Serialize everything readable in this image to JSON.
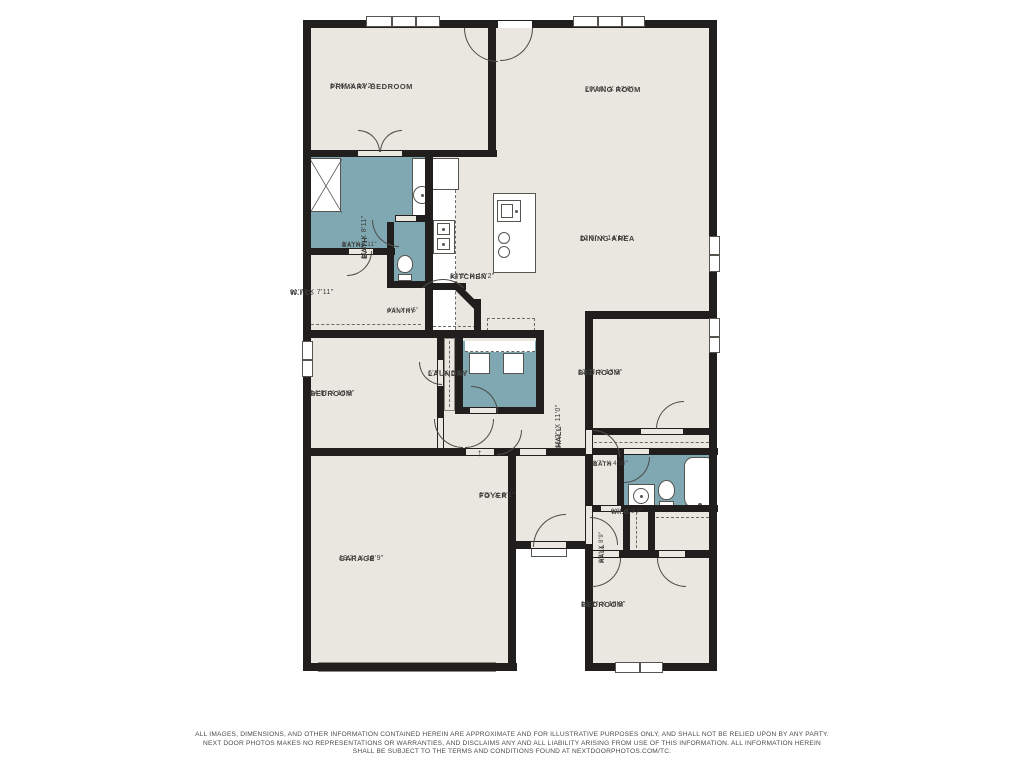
{
  "colors": {
    "floor": "#e9e7df",
    "wet_room": "#7fa8b2",
    "wall": "#201f1d",
    "fixture_line": "#55544f",
    "label_text": "#3e3e3c",
    "background": "#ffffff"
  },
  "rooms": [
    {
      "id": "primary-bedroom",
      "name": "PRIMARY BEDROOM",
      "dims": "17'6\" X 12'2\"",
      "x": 400,
      "y": 92,
      "rot": 0,
      "small": false
    },
    {
      "id": "living-room",
      "name": "LIVING ROOM",
      "dims": "20'10\" X 12'6\"",
      "x": 655,
      "y": 95,
      "rot": 0,
      "small": false
    },
    {
      "id": "dining-area",
      "name": "DINING AREA",
      "dims": "12'6\" X 14'10\"",
      "x": 650,
      "y": 244,
      "rot": 0,
      "small": false
    },
    {
      "id": "kitchen",
      "name": "KITCHEN",
      "dims": "14'2\" X 17'2\"",
      "x": 520,
      "y": 282,
      "rot": 0,
      "small": false
    },
    {
      "id": "bath-primary",
      "name": "BATH",
      "dims": "11'7\" X 8'11\"",
      "x": 360,
      "y": 199,
      "rot": -90,
      "small": false
    },
    {
      "id": "bath-small",
      "name": "BATH",
      "dims": "3'4\" X 4'11\"",
      "x": 412,
      "y": 252,
      "rot": 0,
      "small": true
    },
    {
      "id": "wic-primary",
      "name": "W.I.C.",
      "dims": "11'7\" X 7'11\"",
      "x": 360,
      "y": 298,
      "rot": 0,
      "small": false
    },
    {
      "id": "pantry",
      "name": "PANTRY",
      "dims": "4'6\" X 4'5\"",
      "x": 457,
      "y": 318,
      "rot": 0,
      "small": true
    },
    {
      "id": "laundry",
      "name": "LAUNDRY",
      "dims": "6'3\" X 6'11\"",
      "x": 498,
      "y": 379,
      "rot": 0,
      "small": false
    },
    {
      "id": "hall-main",
      "name": "HALL",
      "dims": "11'2\" X 11'0\"",
      "x": 554,
      "y": 388,
      "rot": -90,
      "small": false
    },
    {
      "id": "bedroom-right",
      "name": "BEDROOM",
      "dims": "12'2\" X 13'3\"",
      "x": 648,
      "y": 378,
      "rot": 0,
      "small": false
    },
    {
      "id": "bedroom-left",
      "name": "BEDROOM",
      "dims": "14'8\" X 10'8\"",
      "x": 380,
      "y": 399,
      "rot": 0,
      "small": false
    },
    {
      "id": "foyer",
      "name": "FOYER",
      "dims": "6'5\" X 9'1\"",
      "x": 549,
      "y": 501,
      "rot": 0,
      "small": false
    },
    {
      "id": "hall-small",
      "name": "HALL",
      "dims": "3'3\" X 8'9\"",
      "x": 599,
      "y": 503,
      "rot": -90,
      "small": true
    },
    {
      "id": "bath-right",
      "name": "BATH",
      "dims": "8'7\" X 4'10\"",
      "x": 663,
      "y": 471,
      "rot": 0,
      "small": true
    },
    {
      "id": "wic-right",
      "name": "W.I.C.",
      "dims": "6'3\" X 3'7\"",
      "x": 681,
      "y": 519,
      "rot": 0,
      "small": true
    },
    {
      "id": "garage",
      "name": "GARAGE",
      "dims": "19'2\" X 19'9\"",
      "x": 409,
      "y": 564,
      "rot": 0,
      "small": false
    },
    {
      "id": "bedroom-bottom",
      "name": "BEDROOM",
      "dims": "12'2\" X 10'8\"",
      "x": 651,
      "y": 610,
      "rot": 0,
      "small": false
    }
  ],
  "disclaimer": {
    "line1": "ALL IMAGES, DIMENSIONS, AND OTHER INFORMATION CONTAINED HEREIN ARE APPROXIMATE AND FOR ILLUSTRATIVE PURPOSES ONLY, AND SHALL NOT BE RELIED UPON BY ANY PARTY.",
    "line2": "NEXT DOOR PHOTOS MAKES NO REPRESENTATIONS OR WARRANTIES, AND DISCLAIMS ANY AND ALL LIABILITY ARISING FROM USE OF THIS INFORMATION. ALL INFORMATION HEREIN",
    "line3": "SHALL BE SUBJECT TO THE TERMS AND CONDITIONS FOUND AT NEXTDOORPHOTOS.COM/TC."
  },
  "geometry": {
    "floors": [
      [
        303,
        20,
        414,
        436
      ],
      [
        303,
        455,
        213,
        216
      ],
      [
        515,
        455,
        72,
        93
      ],
      [
        585,
        455,
        132,
        216
      ]
    ],
    "wet": [
      [
        310,
        157,
        117,
        93
      ],
      [
        391,
        222,
        42,
        62
      ],
      [
        463,
        341,
        74,
        73
      ],
      [
        620,
        455,
        97,
        55
      ]
    ],
    "walls": [
      [
        303,
        20,
        414,
        8
      ],
      [
        303,
        20,
        8,
        651
      ],
      [
        709,
        20,
        8,
        651
      ],
      [
        303,
        663,
        214,
        8
      ],
      [
        585,
        663,
        132,
        8
      ],
      [
        488,
        20,
        8,
        137
      ],
      [
        303,
        150,
        194,
        7
      ],
      [
        425,
        157,
        8,
        181
      ],
      [
        303,
        248,
        92,
        7
      ],
      [
        387,
        222,
        7,
        62
      ],
      [
        387,
        281,
        46,
        7
      ],
      [
        395,
        215,
        38,
        7
      ],
      [
        303,
        330,
        141,
        8
      ],
      [
        437,
        330,
        7,
        125
      ],
      [
        303,
        448,
        213,
        8
      ],
      [
        508,
        448,
        8,
        223
      ],
      [
        585,
        311,
        132,
        8
      ],
      [
        585,
        311,
        8,
        360
      ],
      [
        585,
        428,
        132,
        7
      ],
      [
        592,
        448,
        126,
        7
      ],
      [
        617,
        452,
        7,
        60
      ],
      [
        593,
        505,
        125,
        7
      ],
      [
        623,
        509,
        7,
        48
      ],
      [
        648,
        509,
        7,
        41
      ],
      [
        585,
        550,
        132,
        8
      ],
      [
        515,
        541,
        72,
        8
      ],
      [
        516,
        448,
        70,
        8
      ],
      [
        455,
        337,
        8,
        77
      ],
      [
        536,
        337,
        8,
        77
      ],
      [
        428,
        330,
        116,
        8
      ],
      [
        455,
        407,
        89,
        7
      ],
      [
        428,
        283,
        38,
        7
      ],
      [
        474,
        299,
        7,
        38
      ]
    ],
    "wall_rot": [
      {
        "x": 456,
        "y": 281,
        "w": 34,
        "h": 7,
        "rot": 45
      }
    ],
    "openings": [
      {
        "r": [
          358,
          151,
          44,
          5
        ],
        "c": "f"
      },
      {
        "r": [
          498,
          21,
          34,
          7
        ],
        "c": "w"
      },
      {
        "r": [
          396,
          216,
          20,
          5
        ],
        "c": "f"
      },
      {
        "r": [
          349,
          249,
          24,
          5
        ],
        "c": "f"
      },
      {
        "r": [
          438,
          360,
          5,
          26
        ],
        "c": "f"
      },
      {
        "r": [
          438,
          418,
          5,
          30
        ],
        "c": "f"
      },
      {
        "r": [
          466,
          449,
          28,
          6
        ],
        "c": "f"
      },
      {
        "r": [
          470,
          408,
          26,
          5
        ],
        "c": "f"
      },
      {
        "r": [
          586,
          430,
          6,
          24
        ],
        "c": "f"
      },
      {
        "r": [
          641,
          429,
          42,
          5
        ],
        "c": "f"
      },
      {
        "r": [
          624,
          449,
          25,
          5
        ],
        "c": "f"
      },
      {
        "r": [
          586,
          506,
          6,
          38
        ],
        "c": "f"
      },
      {
        "r": [
          593,
          551,
          26,
          6
        ],
        "c": "f"
      },
      {
        "r": [
          659,
          551,
          26,
          6
        ],
        "c": "f"
      },
      {
        "r": [
          531,
          542,
          35,
          6
        ],
        "c": "f"
      },
      {
        "r": [
          520,
          449,
          26,
          6
        ],
        "c": "f"
      },
      {
        "r": [
          601,
          506,
          20,
          5
        ],
        "c": "f"
      }
    ],
    "windows": [
      {
        "x": 366,
        "y": 16,
        "w": 74,
        "h": 11,
        "o": "h",
        "panes": 3
      },
      {
        "x": 573,
        "y": 16,
        "w": 72,
        "h": 11,
        "o": "h",
        "panes": 3
      },
      {
        "x": 709,
        "y": 236,
        "w": 11,
        "h": 36,
        "o": "v",
        "panes": 2
      },
      {
        "x": 709,
        "y": 318,
        "w": 11,
        "h": 35,
        "o": "v",
        "panes": 2
      },
      {
        "x": 302,
        "y": 341,
        "w": 11,
        "h": 36,
        "o": "v",
        "panes": 2
      },
      {
        "x": 615,
        "y": 662,
        "w": 48,
        "h": 11,
        "o": "h",
        "panes": 2
      }
    ],
    "doors": [
      {
        "x": 464,
        "y": 28,
        "s": 34,
        "c": "tr"
      },
      {
        "x": 500,
        "y": 28,
        "s": 33,
        "c": "tl"
      },
      {
        "x": 358,
        "y": 130,
        "s": 22,
        "c": "bl"
      },
      {
        "x": 380,
        "y": 130,
        "s": 22,
        "c": "br"
      },
      {
        "x": 372,
        "y": 220,
        "s": 27,
        "c": "tr"
      },
      {
        "x": 347,
        "y": 251,
        "s": 25,
        "c": "tl"
      },
      {
        "x": 443,
        "y": 279,
        "s": 30,
        "c": "bl",
        "rot": -45
      },
      {
        "x": 471,
        "y": 386,
        "s": 27,
        "c": "bl"
      },
      {
        "x": 419,
        "y": 362,
        "s": 23,
        "c": "tr"
      },
      {
        "x": 434,
        "y": 419,
        "s": 29,
        "c": "tr"
      },
      {
        "x": 465,
        "y": 419,
        "s": 29,
        "c": "tl"
      },
      {
        "x": 593,
        "y": 430,
        "s": 27,
        "c": "bl"
      },
      {
        "x": 656,
        "y": 401,
        "s": 28,
        "c": "br"
      },
      {
        "x": 624,
        "y": 457,
        "s": 26,
        "c": "tl"
      },
      {
        "x": 590,
        "y": 517,
        "s": 28,
        "c": "bl"
      },
      {
        "x": 533,
        "y": 514,
        "s": 33,
        "c": "br"
      },
      {
        "x": 497,
        "y": 430,
        "s": 25,
        "c": "tl"
      },
      {
        "x": 592,
        "y": 558,
        "s": 29,
        "c": "tl"
      },
      {
        "x": 657,
        "y": 558,
        "s": 29,
        "c": "tr"
      }
    ],
    "fixtures": [
      {
        "t": "shower",
        "x": 309,
        "y": 158,
        "w": 32,
        "h": 54,
        "n": "shower"
      },
      {
        "t": "rect",
        "x": 412,
        "y": 158,
        "w": 20,
        "h": 62,
        "n": "vanity"
      },
      {
        "t": "sinkround",
        "x": 413,
        "y": 186,
        "w": 18,
        "h": 18,
        "n": "sink"
      },
      {
        "t": "toilet",
        "x": 397,
        "y": 255,
        "w": 16,
        "h": 26,
        "n": "toilet"
      },
      {
        "t": "rect",
        "x": 432,
        "y": 158,
        "w": 27,
        "h": 32,
        "n": "fridge"
      },
      {
        "t": "counter",
        "x": 432,
        "y": 190,
        "w": 24,
        "h": 140,
        "n": "kitchen-counter"
      },
      {
        "t": "stove",
        "x": 433,
        "y": 220,
        "w": 22,
        "h": 34,
        "n": "stove"
      },
      {
        "t": "rect",
        "x": 493,
        "y": 193,
        "w": 43,
        "h": 80,
        "n": "island"
      },
      {
        "t": "sinksq",
        "x": 497,
        "y": 200,
        "w": 24,
        "h": 22,
        "n": "island-sink"
      },
      {
        "t": "burners",
        "x": 496,
        "y": 232,
        "w": 20,
        "h": 26,
        "n": "cooktop"
      },
      {
        "t": "dashrect",
        "x": 487,
        "y": 318,
        "w": 48,
        "h": 13,
        "n": "counter-dashed"
      },
      {
        "t": "strip",
        "x": 465,
        "y": 341,
        "w": 70,
        "h": 11,
        "n": "laundry-shelf"
      },
      {
        "t": "rect",
        "x": 469,
        "y": 353,
        "w": 21,
        "h": 21,
        "n": "washer"
      },
      {
        "t": "rect",
        "x": 503,
        "y": 353,
        "w": 21,
        "h": 21,
        "n": "dryer"
      },
      {
        "t": "closet",
        "x": 444,
        "y": 338,
        "w": 11,
        "h": 73,
        "n": "linen-closet"
      },
      {
        "t": "rect",
        "x": 628,
        "y": 484,
        "w": 27,
        "h": 25,
        "n": "vanity2"
      },
      {
        "t": "sinkround",
        "x": 633,
        "y": 488,
        "w": 16,
        "h": 16,
        "n": "sink2"
      },
      {
        "t": "toilet",
        "x": 658,
        "y": 480,
        "w": 17,
        "h": 28,
        "n": "toilet2"
      },
      {
        "t": "tub",
        "x": 684,
        "y": 457,
        "w": 31,
        "h": 52,
        "n": "bathtub"
      },
      {
        "t": "rect",
        "x": 531,
        "y": 548,
        "w": 36,
        "h": 9,
        "n": "porch-step"
      },
      {
        "t": "garagedoor",
        "x": 318,
        "y": 662,
        "w": 178,
        "h": 10,
        "n": "garage-door"
      },
      {
        "t": "arrow",
        "x": 477,
        "y": 448,
        "w": 14,
        "h": 14,
        "n": "entry-arrow"
      }
    ],
    "dashes": [
      {
        "o": "h",
        "x": 311,
        "y": 324,
        "l": 110
      },
      {
        "o": "h",
        "x": 465,
        "y": 351,
        "l": 70
      },
      {
        "o": "h",
        "x": 594,
        "y": 442,
        "l": 120
      },
      {
        "o": "h",
        "x": 656,
        "y": 517,
        "l": 58
      },
      {
        "o": "v",
        "x": 449,
        "y": 341,
        "l": 66
      },
      {
        "o": "v",
        "x": 636,
        "y": 512,
        "l": 36
      },
      {
        "o": "h",
        "x": 433,
        "y": 326,
        "l": 43
      }
    ]
  }
}
